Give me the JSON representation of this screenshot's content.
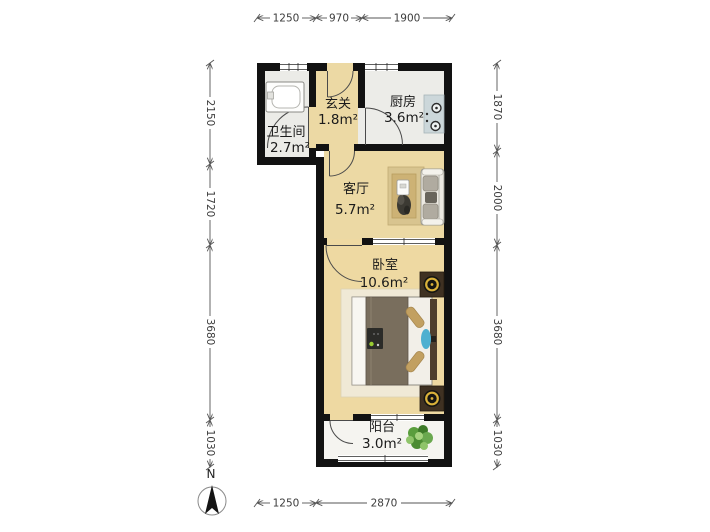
{
  "rooms": {
    "bathroom": {
      "label": "卫生间",
      "area": "2.7m²"
    },
    "entry": {
      "label": "玄关",
      "area": "1.8m²"
    },
    "kitchen": {
      "label": "厨房",
      "area": "3.6m²"
    },
    "living": {
      "label": "客厅",
      "area": "5.7m²"
    },
    "bedroom": {
      "label": "卧室",
      "area": "10.6m²"
    },
    "balcony": {
      "label": "阳台",
      "area": "3.0m²"
    }
  },
  "dimensions": {
    "top": [
      "1250",
      "970",
      "1900"
    ],
    "bottom": [
      "1250",
      "2870"
    ],
    "left": [
      "2150",
      "1720",
      "3680",
      "1030"
    ],
    "right": [
      "1870",
      "2000",
      "3680",
      "1030"
    ]
  },
  "compass": {
    "north_label": "N"
  },
  "colors": {
    "wall": "#121212",
    "wood_floor": "#ecd9a4",
    "tile_floor": "#ebebe7",
    "balcony_floor": "#f5f4f0",
    "kitchen_counter": "#ccd7da",
    "living_rug": "#d8c48f",
    "sofa": "#ece9e2",
    "bed_duvet": "#796e5d",
    "pillow_tan": "#c2a061",
    "accent_blue": "#4fb0d0",
    "lamp_yellow": "#d9b13a",
    "nightstand_brown": "#3f3122",
    "plant_green": "#5a9e3d",
    "dimension_text": "#3c3c3c"
  }
}
